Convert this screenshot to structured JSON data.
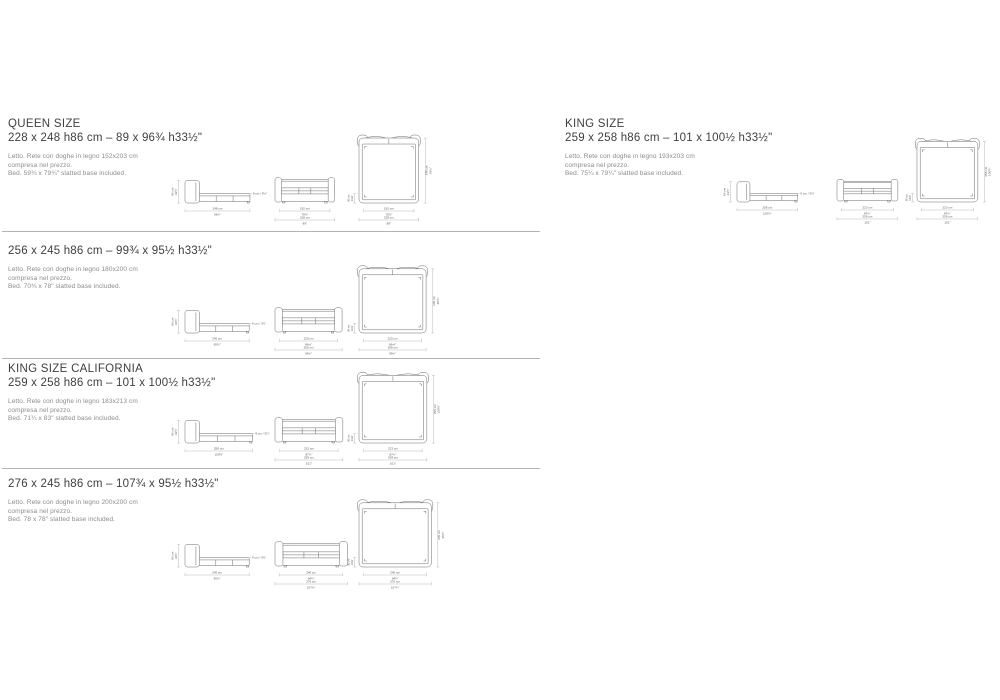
{
  "colors": {
    "object_line": "#6a6a6a",
    "dim_line": "#9c9c9c",
    "dim_text": "#5a5a5a",
    "divider": "#b3b3b3",
    "background": "#ffffff"
  },
  "sections": [
    {
      "id": "queen",
      "title": "QUEEN SIZE",
      "size_line": "228 x 248 h86 cm – 89 x 96¾ h33½\"",
      "desc": [
        "Letto. Rete con doghe in legno 152x203 cm",
        "compresa nel prezzo.",
        "Bed. 59¾ x 79¾\" slatted base included."
      ],
      "drawing": {
        "cm": {
          "width": 228,
          "length": 248,
          "height": 86,
          "inner_width": 192,
          "platform_depth": 36,
          "mattress_thickness": 9
        },
        "labels": {
          "height": [
            "86 cm",
            "33½\""
          ],
          "length": [
            "248 cm",
            "96¾\""
          ],
          "inner_width": [
            "192 cm",
            "75½\""
          ],
          "overall_width": [
            "228 cm",
            "89\""
          ],
          "platform": [
            "36 cm",
            "14⅛\""
          ],
          "mattress": "9 cm / 3½\""
        }
      }
    },
    {
      "id": "queen-256",
      "title": "",
      "size_line": "256 x 245 h86 cm – 99¾ x 95½ h33½\"",
      "desc": [
        "Letto. Rete con doghe in legno 180x200 cm",
        "compresa nel prezzo.",
        "Bed. 70¾ x 78\" slatted base included."
      ],
      "drawing": {
        "cm": {
          "width": 256,
          "length": 245,
          "height": 86,
          "inner_width": 220,
          "platform_depth": 36,
          "mattress_thickness": 9
        },
        "labels": {
          "height": [
            "86 cm",
            "33½\""
          ],
          "length": [
            "245 cm",
            "95½\""
          ],
          "inner_width": [
            "220 cm",
            "86⅝\""
          ],
          "overall_width": [
            "256 cm",
            "99¾\""
          ],
          "platform": [
            "36 cm",
            "14⅛\""
          ],
          "mattress": "9 cm / 3½\""
        }
      }
    },
    {
      "id": "king-california",
      "title": "KING SIZE CALIFORNIA",
      "size_line": "259 x 258 h86 cm – 101 x 100½ h33½\"",
      "desc": [
        "Letto. Rete con doghe in legno 183x213 cm",
        "compresa nel prezzo.",
        "Bed. 71¼ x 83\" slatted base included."
      ],
      "drawing": {
        "cm": {
          "width": 259,
          "length": 258,
          "height": 86,
          "inner_width": 223,
          "platform_depth": 36,
          "mattress_thickness": 9
        },
        "labels": {
          "height": [
            "86 cm",
            "33½\""
          ],
          "length": [
            "258 cm",
            "100½\""
          ],
          "inner_width": [
            "223 cm",
            "87¾\""
          ],
          "overall_width": [
            "259 cm",
            "101\""
          ],
          "platform": [
            "36 cm",
            "14⅛\""
          ],
          "mattress": "9 cm / 3½\""
        }
      }
    },
    {
      "id": "king-276",
      "title": "",
      "size_line": "276 x 245 h86 cm – 107¾ x 95½ h33½\"",
      "desc": [
        "Letto. Rete con doghe in legno 200x200 cm",
        "compresa nel prezzo.",
        "Bed. 78 x 78\" slatted base included."
      ],
      "drawing": {
        "cm": {
          "width": 276,
          "length": 245,
          "height": 86,
          "inner_width": 240,
          "platform_depth": 36,
          "mattress_thickness": 9
        },
        "labels": {
          "height": [
            "86 cm",
            "33½\""
          ],
          "length": [
            "245 cm",
            "95½\""
          ],
          "inner_width": [
            "240 cm",
            "94½\""
          ],
          "overall_width": [
            "276 cm",
            "107¾\""
          ],
          "platform": [
            "36 cm",
            "14⅛\""
          ],
          "mattress": "9 cm / 3½\""
        }
      }
    },
    {
      "id": "king",
      "title": "KING SIZE",
      "size_line": "259 x 258 h86 cm – 101 x 100½ h33½\"",
      "desc": [
        "Letto. Rete con doghe in legno 193x203 cm",
        "compresa nel prezzo.",
        "Bed. 75¼ x 79¼\" slatted base included."
      ],
      "drawing": {
        "cm": {
          "width": 259,
          "length": 258,
          "height": 86,
          "inner_width": 223,
          "platform_depth": 36,
          "mattress_thickness": 9
        },
        "labels": {
          "height": [
            "86 cm",
            "33½\""
          ],
          "length": [
            "258 cm",
            "100½\""
          ],
          "inner_width": [
            "223 cm",
            "87¾\""
          ],
          "overall_width": [
            "259 cm",
            "101\""
          ],
          "platform": [
            "36 cm",
            "14⅛\""
          ],
          "mattress": "9 cm / 3½\""
        }
      }
    }
  ]
}
